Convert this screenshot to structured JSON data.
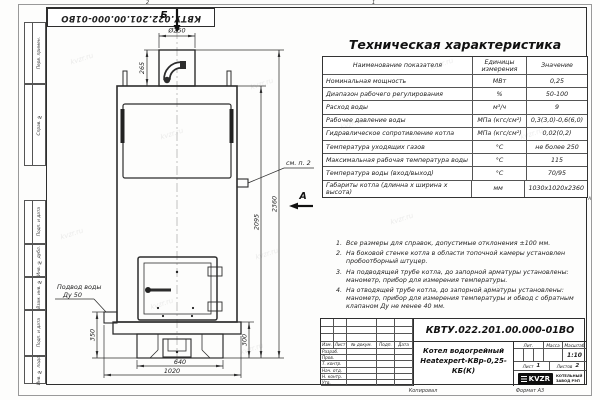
{
  "doc": {
    "number": "КВТУ.022.201.00.000-01ВО"
  },
  "frame": {
    "left_labels": [
      "Перв. примен.",
      "Справ. №",
      "Подп. и дата",
      "Инв. № дубл.",
      "Взам. инв. №",
      "Подп. и дата",
      "Инв. № подл."
    ],
    "zone_left": "2",
    "zone_right": "1",
    "zone_letter": "А",
    "copied": "Копировал",
    "format": "Формат А3"
  },
  "drawing": {
    "view_top": "Б",
    "view_side": "А",
    "see_note": "см. п. 2",
    "inlet_line1": "Подвод воды",
    "inlet_line2": "Ду 50",
    "dims": {
      "chimney_d": "Ø250",
      "chimney_h": "265",
      "total_h": "2360",
      "body_h": "2095",
      "left_h": "350",
      "right_h": "300",
      "base_w": "640",
      "total_w": "1020"
    }
  },
  "spec": {
    "title": "Техническая характеристика",
    "headers": {
      "name": "Наименование показателя",
      "unit": "Единицы измерения",
      "value": "Значение"
    },
    "rows": [
      {
        "name": "Номинальная мощность",
        "unit": "МВт",
        "value": "0,25"
      },
      {
        "name": "Диапазон рабочего регулирования",
        "unit": "%",
        "value": "50-100"
      },
      {
        "name": "Расход воды",
        "unit": "м³/ч",
        "value": "9"
      },
      {
        "name": "Рабочее давление воды",
        "unit": "МПа (кгс/см²)",
        "value": "0,3(3,0)-0,6(6,0)"
      },
      {
        "name": "Гидравлическое сопротивление котла",
        "unit": "МПа (кгс/см²)",
        "value": "0,02(0,2)"
      },
      {
        "name": "Температура уходящих газов",
        "unit": "°С",
        "value": "не более 250"
      },
      {
        "name": "Максимальная рабочая температура воды",
        "unit": "°С",
        "value": "115"
      },
      {
        "name": "Температура воды (вход/выход)",
        "unit": "°С",
        "value": "70/95"
      },
      {
        "name": "Габариты котла (длинна х ширина х высота)",
        "unit": "мм",
        "value": "1030х1020х2360"
      }
    ]
  },
  "notes": {
    "items": [
      {
        "n": "1.",
        "text": "Все размеры для справок, допустимые отклонения ±100 мм."
      },
      {
        "n": "2.",
        "text": "На боковой стенке котла в области топочной камеры установлен пробоотборный штуцер."
      },
      {
        "n": "3.",
        "text": "На подводящей трубе котла, до запорной арматуры установлены: манометр, прибор для измерения температуры."
      },
      {
        "n": "4.",
        "text": "На отводящей трубе котла, до запорной арматуры установлены: манометр, прибор для измерения температуры и обвод с обратным клапаном Ду не менее 40 мм."
      }
    ]
  },
  "tb": {
    "doc_number": "КВТУ.022.201.00.000-01ВО",
    "name1": "Котел водогрейный",
    "name2": "Heatexpert-КВр-0,25-КБ(К)",
    "cols": [
      "Изм.",
      "Лист",
      "№ докум.",
      "Подп.",
      "Дата"
    ],
    "rows": [
      "Разраб.",
      "Пров.",
      "Т. контр.",
      "Нач. отд.",
      "Н. контр.",
      "Утв."
    ],
    "lit": "Лит.",
    "mass": "Масса",
    "scale": "Масштаб",
    "scale_value": "1:10",
    "sheet": "Лист",
    "sheet_value": "1",
    "sheets": "Листов",
    "sheets_value": "2",
    "logo": "KVZR",
    "company1": "КОТЕЛЬНЫЙ",
    "company2": "ЗАВОД РЭП"
  },
  "watermark": {
    "text": "kvzr.ru"
  }
}
